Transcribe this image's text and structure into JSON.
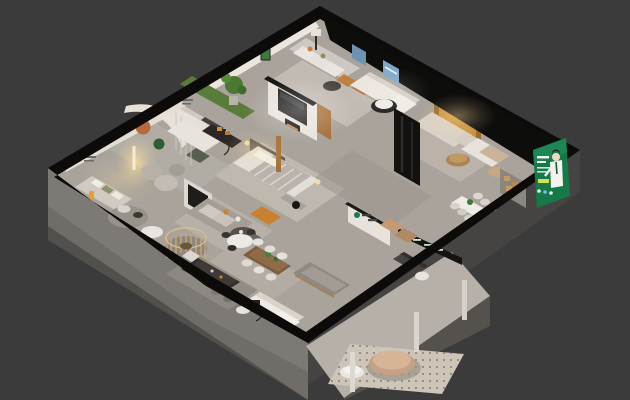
{
  "image": {
    "kind": "3d-isometric-apartment-floorplan-render",
    "width": 630,
    "height": 400,
    "legible_text": "none (all signage too small to read)"
  },
  "palette": {
    "background": "#3b3b3b",
    "wallTop": "#0c0b0a",
    "exteriorWall": "#7d7974",
    "exteriorWallDark": "#68645f",
    "exteriorFaceSE": "#464443",
    "floor": "#a9a39b",
    "rug": "#c3bdb4",
    "wallWhite": "#e8e3db",
    "woodAccent": "#a8713a",
    "orangeAccent": "#c9812f",
    "grassGreen": "#5a7c3b",
    "plantGreen": "#4a7a32",
    "bannerGreen": "#15794a",
    "skyBlue": "#7fa7c9",
    "lampWarm": "#f5d9a8"
  },
  "objects": [
    "exterior-walls",
    "wall-top-ring",
    "terrace",
    "terrace-rug",
    "terrace-tables",
    "terrace-columns",
    "indoor-grass-strip",
    "potted-plant",
    "curved-feature-wall",
    "wall-circle-decor",
    "floor-lamp",
    "spiral-staircase",
    "media-wall",
    "living-room-sofa",
    "white-sofa",
    "lounge-sofa",
    "orange-ottoman",
    "bed",
    "bed-bench",
    "wardrobe",
    "tv-partition",
    "brand-partition",
    "brand-beam",
    "kitchen-counter",
    "dining-table-wood",
    "dining-table-round",
    "long-gray-sofa",
    "corner-white-sofa",
    "sectional-sofa",
    "orange-feature-wall",
    "beige-sofas",
    "round-tables",
    "right-bedroom",
    "right-dining-set",
    "reception-desk",
    "shelf-unit",
    "green-ad-banner",
    "sky-windows",
    "wall-sign-smudges"
  ]
}
